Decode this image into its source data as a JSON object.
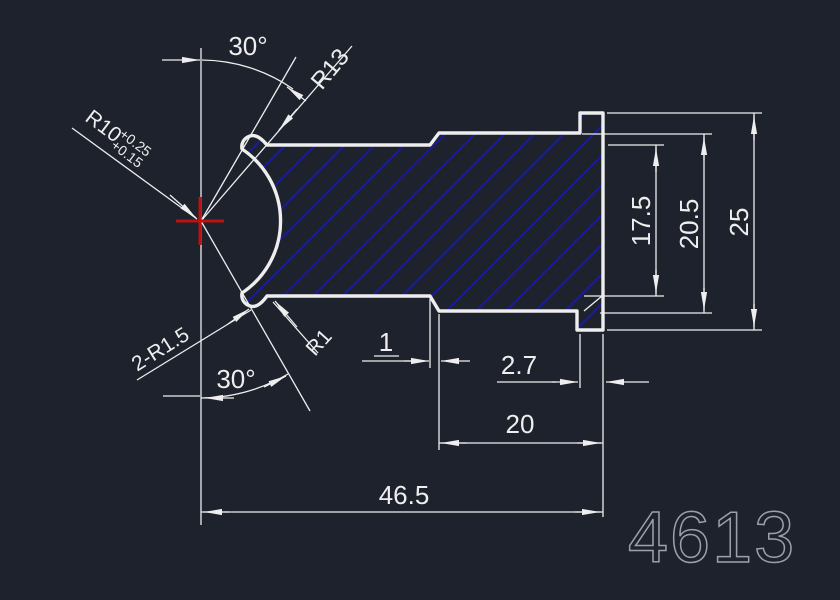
{
  "drawing": {
    "number": "4613",
    "labels": {
      "angle_top": "30°",
      "angle_bottom": "30°",
      "radius_lip": "R13",
      "radius_socket": "R10",
      "socket_tol_upper": "+0.25",
      "socket_tol_lower": "+0.15",
      "fillet_pair": "2-R1.5",
      "fillet_small": "R1",
      "chamfer_length": "1",
      "flange_width": "2.7",
      "shoulder_length": "20",
      "total_length": "46.5",
      "height_inner": "17.5",
      "height_body": "20.5",
      "height_flange": "25"
    },
    "colors": {
      "background": "#1e222c",
      "line": "#eeeeee",
      "hatch": "#1717c4",
      "center_mark": "#bb1111",
      "number_gray": "#9ba1ab"
    }
  }
}
